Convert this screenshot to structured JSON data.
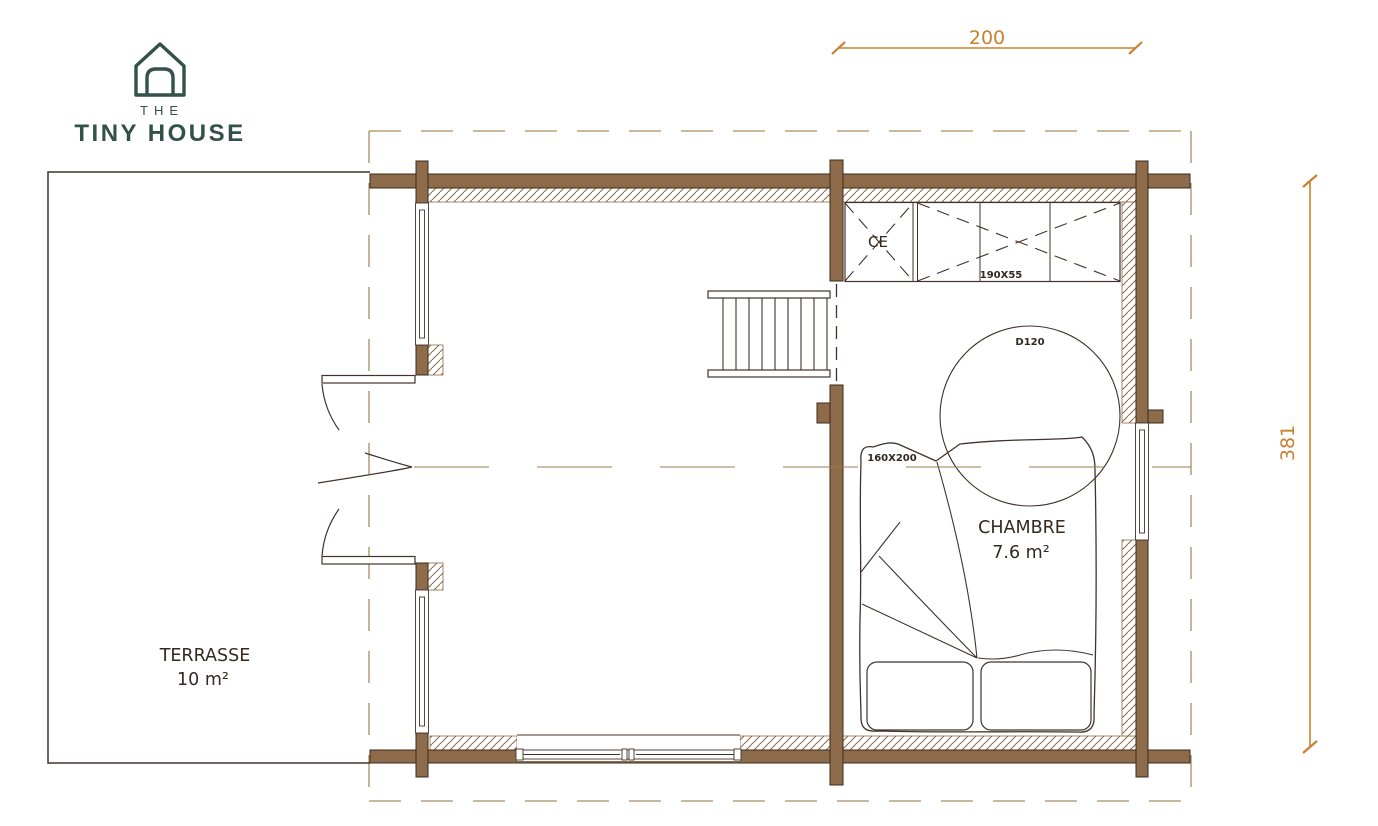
{
  "brand": {
    "top": "THE",
    "name": "TINY HOUSE"
  },
  "dimensions": {
    "width_cm": "200",
    "height_cm": "381"
  },
  "rooms": {
    "terrasse": {
      "name": "TERRASSE",
      "area": "10 m²"
    },
    "chambre": {
      "name": "CHAMBRE",
      "area": "7.6 m²"
    }
  },
  "labels": {
    "water_heater": "CE",
    "closet_size": "190X55",
    "skylight": "D120",
    "bed_size": "160X200"
  },
  "colors": {
    "wall_brown": "#8d6b4b",
    "drawing_line": "#42332a",
    "dimension_orange": "#c9802f",
    "brand_green": "#325149",
    "overhang_dash": "#ab8c64"
  }
}
